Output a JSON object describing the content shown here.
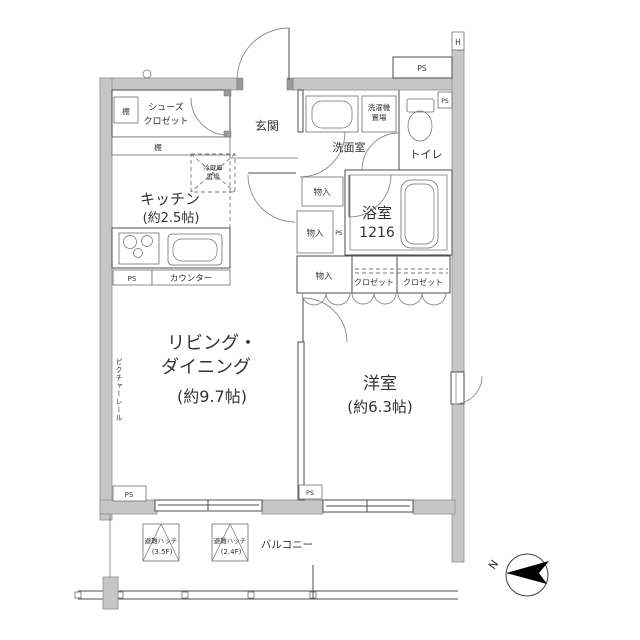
{
  "title": "間取り図",
  "colors": {
    "wall_gray": "#c6c6c6",
    "line": "#4d4d4d",
    "text": "#333333",
    "background": "#ffffff",
    "compass_fill": "#000000"
  },
  "rooms": {
    "shoes_closet": {
      "name": [
        "シューズ",
        "クロゼット"
      ]
    },
    "entrance": {
      "name": "玄関"
    },
    "kitchen": {
      "name": "キッチン",
      "size": "(約2.5帖)"
    },
    "washroom": {
      "name": "洗面室"
    },
    "toilet": {
      "name": "トイレ"
    },
    "bath": {
      "name": "浴室",
      "size": "1216"
    },
    "living_dining": {
      "name": [
        "リビング・",
        "ダイニング"
      ],
      "size": "(約9.7帖)"
    },
    "western_room": {
      "name": "洋室",
      "size": "(約6.3帖)"
    },
    "balcony": {
      "name": "バルコニー"
    }
  },
  "fixtures": {
    "shelf_upper": "棚",
    "shelf_lower": "棚",
    "fridge_space": [
      "冷蔵庫",
      "置場"
    ],
    "counter": "カウンター",
    "washer_space": [
      "洗濯機",
      "置場"
    ],
    "storage_hall": "物入",
    "storage_mid": "物入",
    "storage_row": "物入",
    "closet_row_1": "クロゼット",
    "closet_row_2": "クロゼット",
    "picture_rail": "ピクチャーレール"
  },
  "ps_labels": {
    "top": "PS",
    "toilet": "PS",
    "washroom": "PS",
    "kitchen": "PS",
    "living": "PS",
    "western": "PS"
  },
  "balcony_items": {
    "hatch_1": {
      "name": "避難ハッチ",
      "floor": "(3.5F)"
    },
    "hatch_2": {
      "name": "避難ハッチ",
      "floor": "(2.4F)"
    }
  },
  "marks": {
    "north": "N",
    "hydrant": "H"
  }
}
